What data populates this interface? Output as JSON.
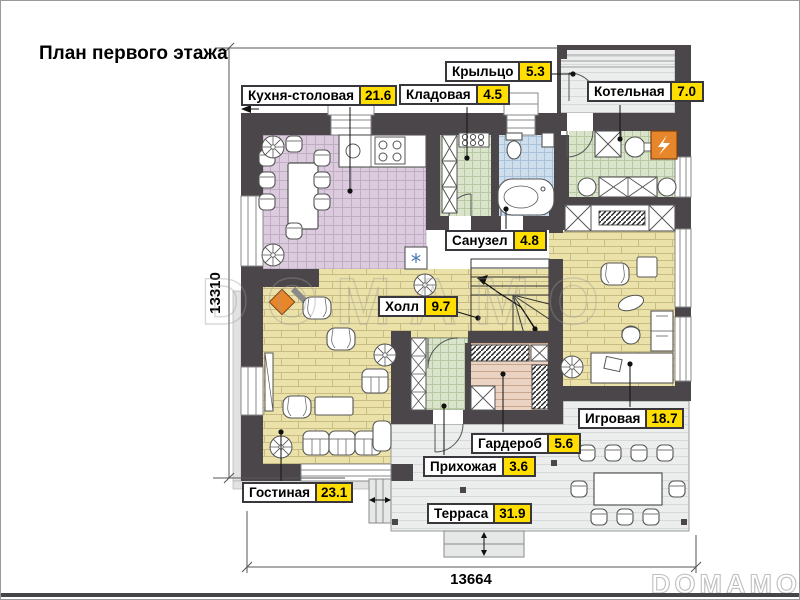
{
  "title": "План первого этажа",
  "plan": {
    "dimension_left": "13310",
    "dimension_bottom": "13664"
  },
  "watermarks": {
    "center": "DOMAMO",
    "corner": "DOMAMO"
  },
  "rooms": [
    {
      "id": "kitchen-dining",
      "name": "Кухня-столовая",
      "area": "21.6"
    },
    {
      "id": "pantry",
      "name": "Кладовая",
      "area": "4.5"
    },
    {
      "id": "porch",
      "name": "Крыльцо",
      "area": "5.3"
    },
    {
      "id": "boiler",
      "name": "Котельная",
      "area": "7.0"
    },
    {
      "id": "bathroom",
      "name": "Санузел",
      "area": "4.8"
    },
    {
      "id": "hall",
      "name": "Холл",
      "area": "9.7"
    },
    {
      "id": "playroom",
      "name": "Игровая",
      "area": "18.7"
    },
    {
      "id": "wardrobe",
      "name": "Гардероб",
      "area": "5.6"
    },
    {
      "id": "entry",
      "name": "Прихожая",
      "area": "3.6"
    },
    {
      "id": "living",
      "name": "Гостиная",
      "area": "23.1"
    },
    {
      "id": "terrace",
      "name": "Терраса",
      "area": "31.9"
    }
  ],
  "colors": {
    "area_badge": "#ffde00",
    "wall": "#4a4649",
    "kitchen_floor": "#dccade",
    "wood_floor": "#ebe2a9",
    "tile_green": "#d9e4cb",
    "tile_blue": "#cfdeed",
    "wardrobe_floor": "#ead3c3",
    "terrace_floor": "#eceeee",
    "accent_orange": "#e8862c"
  }
}
